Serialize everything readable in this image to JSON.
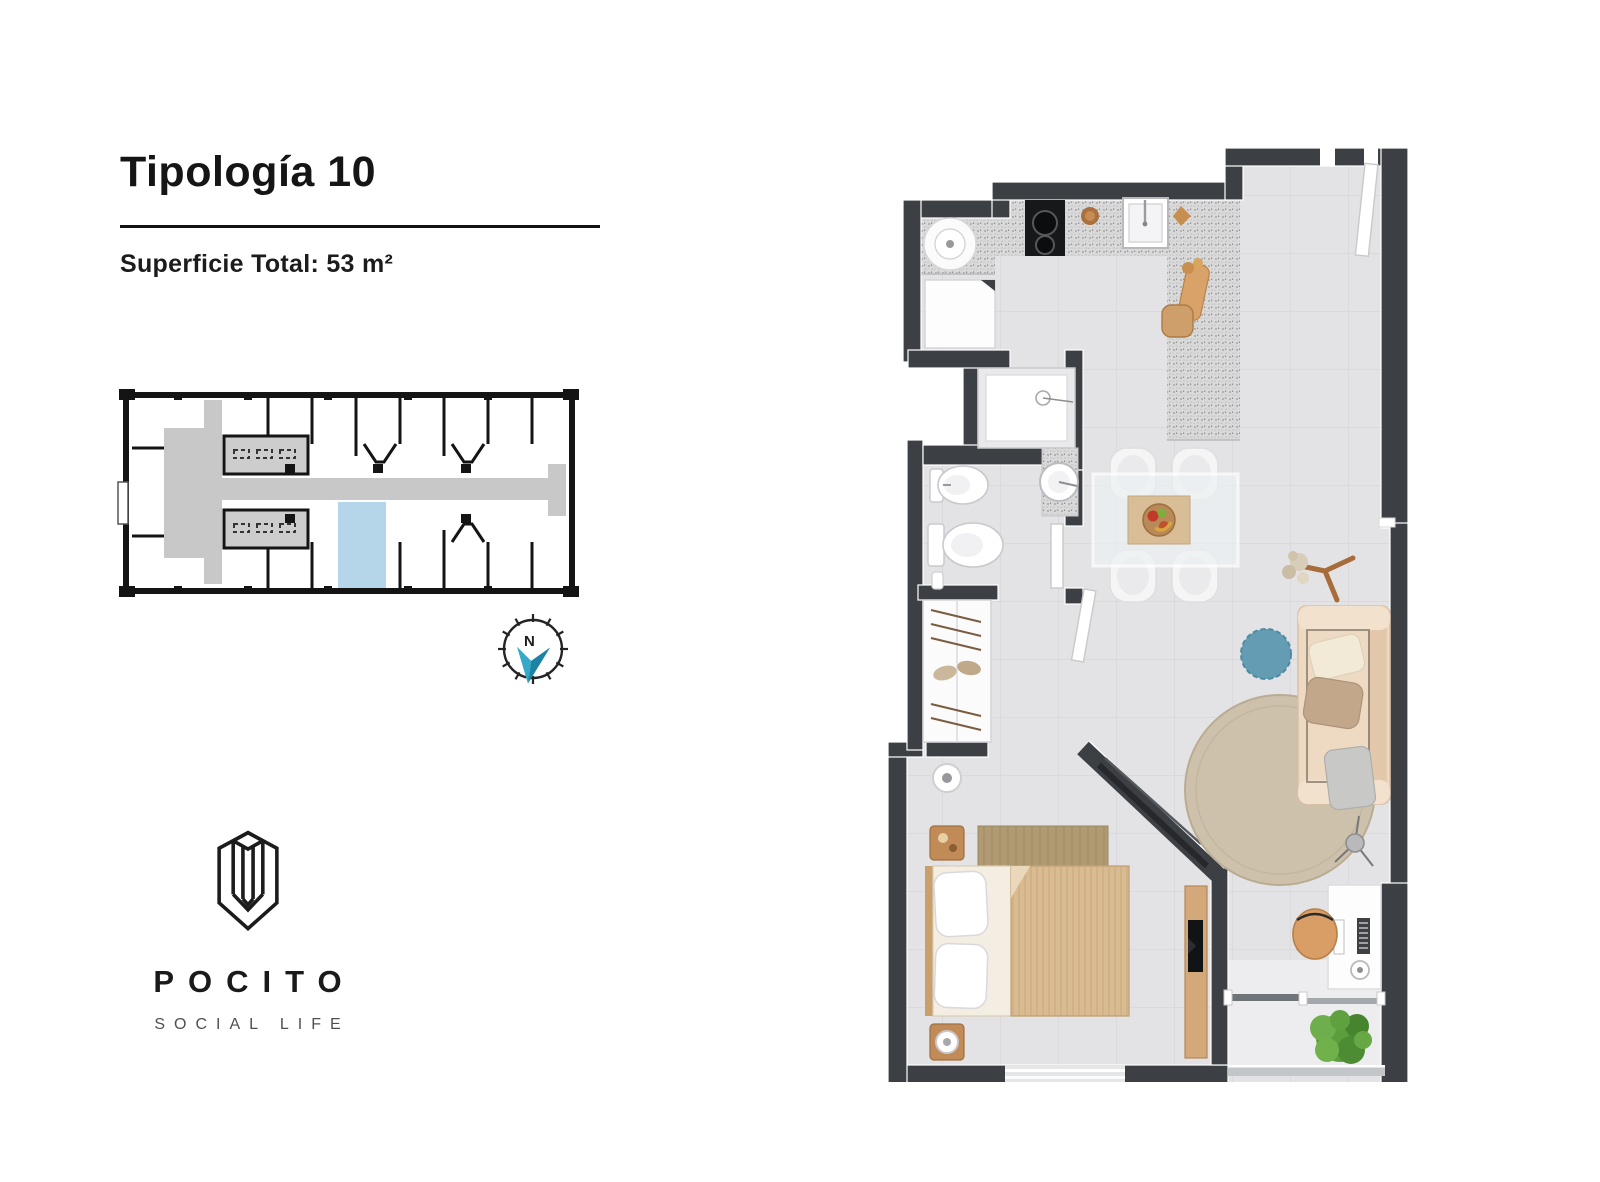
{
  "header": {
    "title": "Tipología 10",
    "area": "Superficie Total: 53 m²"
  },
  "compass": {
    "label": "N"
  },
  "brand": {
    "name": "POCITO",
    "tagline": "SOCIAL LIFE"
  },
  "keyplan": {
    "highlighted_unit": "Tipología 10"
  },
  "colors": {
    "wall": "#3c4045",
    "floor": "#e3e3e5",
    "floor-balcony": "#ededef",
    "counter": "#d9d9d9",
    "wood": "#d2a97a",
    "wood-dark": "#b88a55",
    "duvet": "#d8bb90",
    "sheet": "#f3ede2",
    "bed-rug": "#b09a73",
    "sofa": "#eed9c2",
    "sofa-back": "#e3c7aa",
    "pillow-cream": "#f2ead6",
    "pillow-taupe": "#c2a78b",
    "pillow-gray": "#c8c8c6",
    "pouf": "#649cb3",
    "rug": "#cdc1ab",
    "plant": "#5c9e3d",
    "plant-dark": "#47842e",
    "kwall": "#141414",
    "kcorridor": "#c8c8c8",
    "kunit": "#b5d5e8",
    "needle-light": "#36a9c8",
    "needle-dark": "#1d83a5",
    "ink": "#191919",
    "ink-soft": "#4f4f4f",
    "glass": "#edf1f3"
  }
}
